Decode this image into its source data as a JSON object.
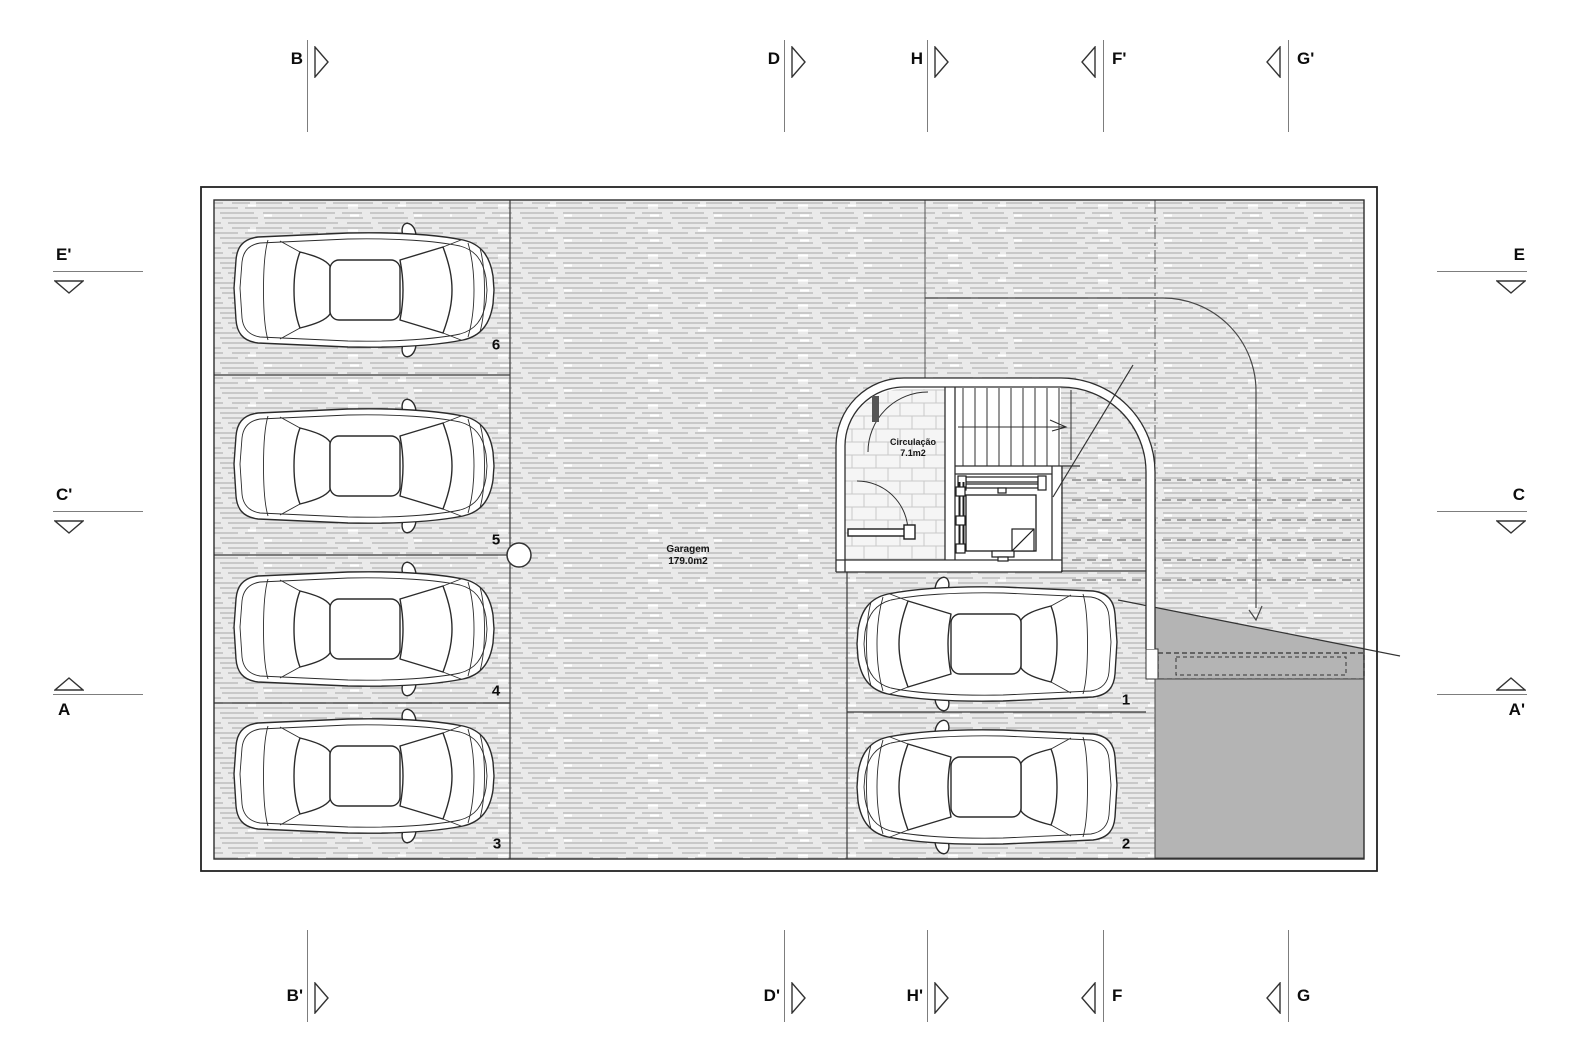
{
  "drawing": {
    "type": "garage floor plan",
    "rooms": {
      "garage": {
        "name": "Garagem",
        "area": "179.0m2"
      },
      "circulation": {
        "name": "Circulação",
        "area": "7.1m2"
      }
    },
    "parking_space_numbers": [
      "1",
      "2",
      "3",
      "4",
      "5",
      "6"
    ]
  },
  "sections": {
    "top": [
      {
        "label": "B"
      },
      {
        "label": "D"
      },
      {
        "label": "H"
      },
      {
        "label": "F'"
      },
      {
        "label": "G'"
      }
    ],
    "bottom": [
      {
        "label": "B'"
      },
      {
        "label": "D'"
      },
      {
        "label": "H'"
      },
      {
        "label": "F"
      },
      {
        "label": "G"
      }
    ],
    "left": [
      {
        "label": "E'"
      },
      {
        "label": "C'"
      },
      {
        "label": "A"
      }
    ],
    "right": [
      {
        "label": "E"
      },
      {
        "label": "C"
      },
      {
        "label": "A'"
      }
    ]
  },
  "colors": {
    "wall_line": "#333333",
    "hatch_dash": "#bdbdbd",
    "hatch_bg": "#eaeaea",
    "tile_line": "#c9c9c9",
    "ramp_fill": "#b4b4b4",
    "marker_line": "#7d7d7d"
  }
}
